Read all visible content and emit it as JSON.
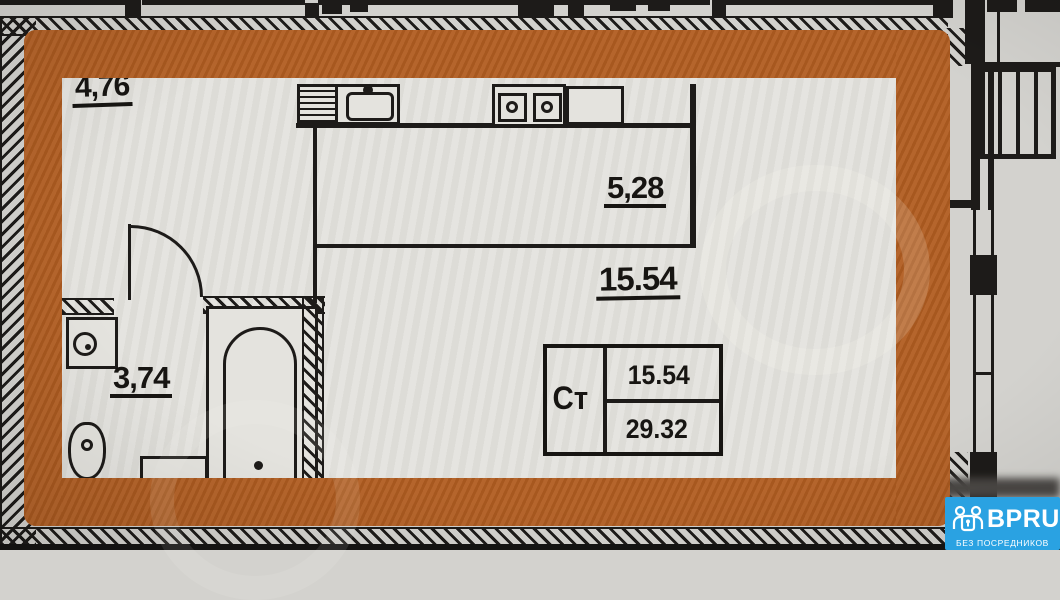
{
  "plan": {
    "labels": {
      "entry_area": "4,76",
      "kitchen_area": "5,28",
      "living_area": "15.54",
      "bathroom_area": "3,74"
    },
    "stamp": {
      "unit_type": "Ст",
      "living_area": "15.54",
      "total_area": "29.32"
    },
    "fixtures": [
      "kitchen-sink",
      "stove",
      "bathtub",
      "washbasin",
      "toilet",
      "door-arc",
      "radiator",
      "window"
    ],
    "colors": {
      "highlight_orange": "#b15d21",
      "ink": "#1d1b19",
      "paper_outer": "#d3d2ce",
      "paper_inner": "#e4e3de",
      "watermark_blue": "#2aa2e2"
    }
  },
  "watermark": {
    "brand": "BPRU",
    "tagline": "БЕЗ ПОСРЕДНИКОВ",
    "logo_icon": "people-lock-icon"
  }
}
